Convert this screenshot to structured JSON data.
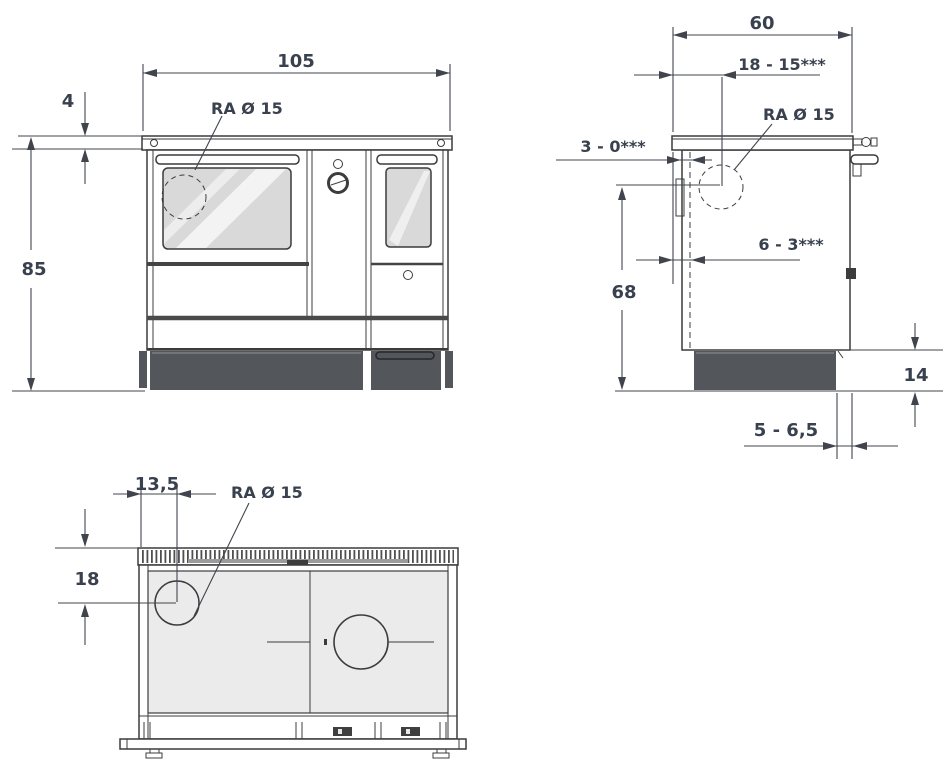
{
  "drawing": {
    "front_view": {
      "width": "105",
      "worktop_thickness": "4",
      "height": "85",
      "flue_label": "RA Ø 15"
    },
    "side_view": {
      "depth": "60",
      "flue_offset_from_back": "18 - 15***",
      "flue_label": "RA Ø 15",
      "back_gap": "3 - 0***",
      "flue_back_offset": "6 - 3***",
      "flue_height": "68",
      "plinth_height": "14",
      "plinth_recess": "5 - 6,5"
    },
    "top_view": {
      "flue_offset_from_left": "13,5",
      "flue_label": "RA Ø 15",
      "flue_offset_from_back": "18"
    },
    "colors": {
      "line": "#3c3c3c",
      "dim_text": "#39404e",
      "plinth": "#53565a",
      "surface": "#ebebeb",
      "glass": "#d9d9d9"
    }
  }
}
